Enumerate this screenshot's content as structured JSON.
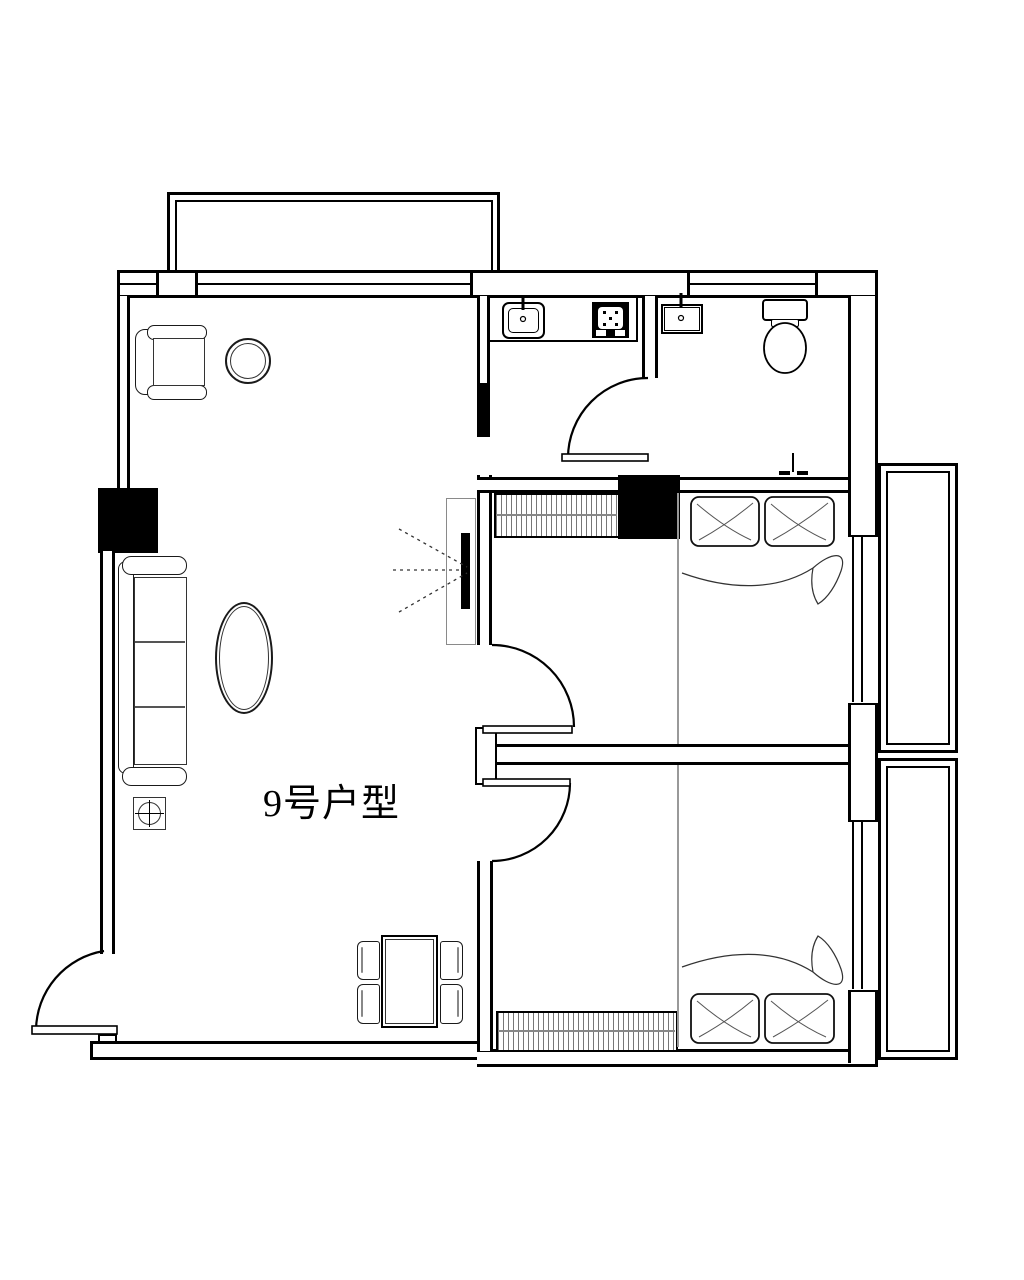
{
  "page": {
    "background": "#ffffff",
    "line_color": "#000000",
    "furniture_line_color": "#1a1a1a",
    "hatch_color": "#777777"
  },
  "plan": {
    "unit_label": "9号户型",
    "legend": [
      "balcony",
      "window-band",
      "wall-pier",
      "structural-column",
      "bay-window",
      "kitchen-counter",
      "kitchen-sink",
      "gas-stove",
      "sliding-panel",
      "bathroom-washbasin",
      "toilet",
      "floor-drain-shower-point",
      "swing-door",
      "double-bed",
      "pillow",
      "blanket",
      "wardrobe",
      "sofa",
      "armchair",
      "round-side-table",
      "oval-coffee-table",
      "crosshair-square-table",
      "tv-panel",
      "tv",
      "tv-signal-rays",
      "dining-table",
      "dining-chair",
      "entrance-door"
    ]
  }
}
